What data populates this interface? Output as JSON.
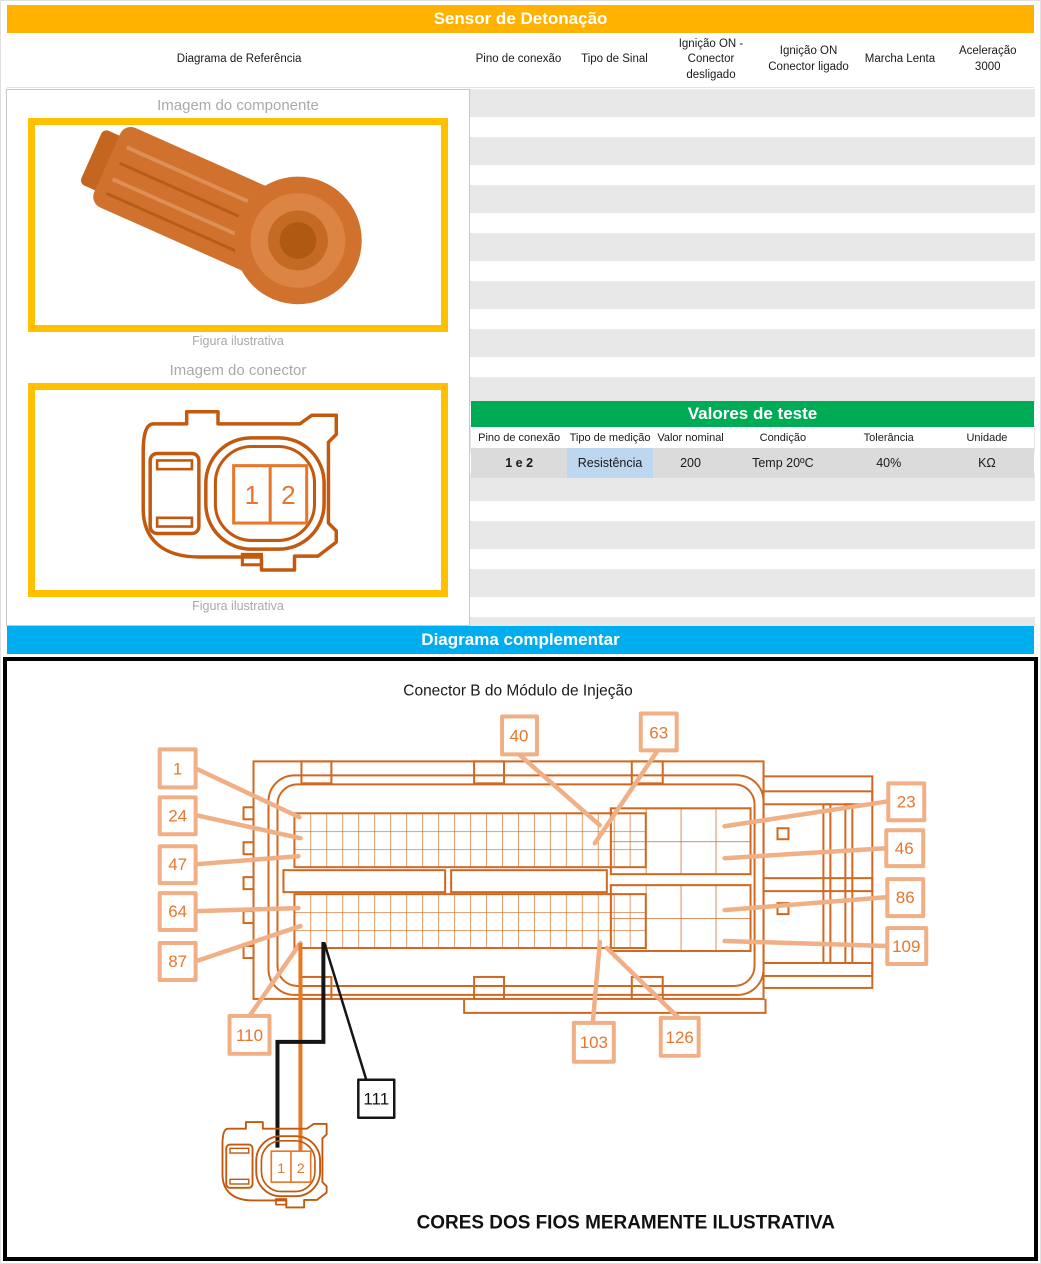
{
  "header": {
    "title": "Sensor de Detonação",
    "section2": "Diagrama complementar"
  },
  "ref_table": {
    "columns": [
      "Diagrama de Referência",
      "Pino de conexão",
      "Tipo de Sinal",
      "Ignição ON - Conector desligado",
      "Ignição ON Conector ligado",
      "Marcha Lenta",
      "Aceleração 3000"
    ]
  },
  "figures": {
    "component": {
      "title": "Imagem do componente",
      "caption": "Figura ilustrativa"
    },
    "connector": {
      "title": "Imagem do conector",
      "caption": "Figura ilustrativa",
      "pin1": "1",
      "pin2": "2"
    }
  },
  "test_table": {
    "title": "Valores de teste",
    "columns": [
      "Pino de conexão",
      "Tipo de medição",
      "Valor nominal",
      "Condição",
      "Tolerância",
      "Unidade"
    ],
    "row": {
      "pino": "1 e 2",
      "tipo": "Resistência",
      "valor": "200",
      "condicao": "Temp 20ºC",
      "tolerancia": "40%",
      "unidade": "KΩ"
    }
  },
  "diagram": {
    "title": "Conector B do Módulo de Injeção",
    "footer": "CORES DOS FIOS MERAMENTE ILUSTRATIVA",
    "pins": [
      "1",
      "24",
      "47",
      "64",
      "87",
      "110",
      "40",
      "63",
      "23",
      "46",
      "86",
      "109",
      "103",
      "126",
      "111"
    ],
    "connector_pins": {
      "pin1": "1",
      "pin2": "2"
    }
  },
  "colors": {
    "header_orange": "#FFB300",
    "header_blue": "#00AEEF",
    "table_green": "#00AB55",
    "highlight_blue": "#BDD7EE",
    "figure_border_yellow": "#FFC000",
    "stripe_gray": "#E8E8E8",
    "row_gray": "#DBDBDB",
    "drawing_orange": "#D06820",
    "label_orange": "#F1AF85",
    "wire_orange": "#E87722",
    "wire_black": "#151515"
  }
}
